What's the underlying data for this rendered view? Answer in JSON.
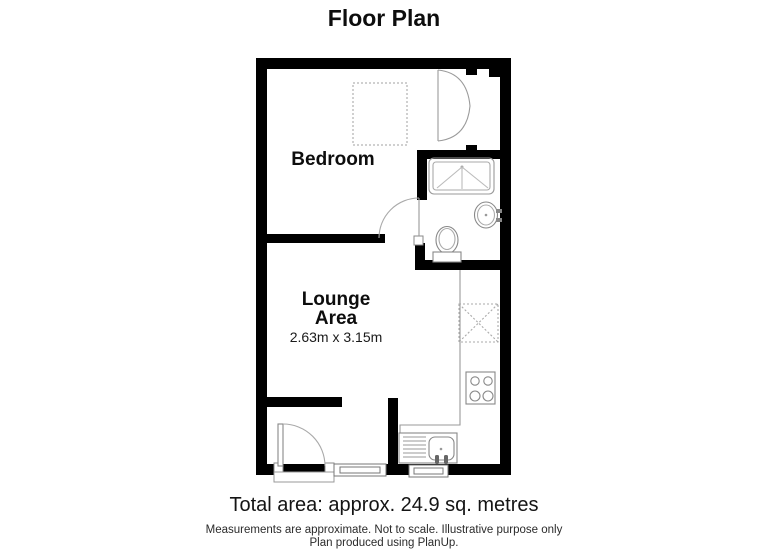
{
  "page": {
    "title": "Floor Plan",
    "background": "#ffffff"
  },
  "plan": {
    "rooms": [
      {
        "name": "bedroom",
        "label": "Bedroom"
      },
      {
        "name": "lounge-area",
        "label_line1": "Lounge",
        "label_line2": "Area",
        "dimensions": "2.63m x 3.15m"
      }
    ],
    "fixtures": [
      "bed-icon",
      "wardrobe-double-door-icon",
      "shower-icon",
      "basin-icon",
      "toilet-icon",
      "bathroom-door-icon",
      "kitchen-counter-line",
      "wall-cabinet-icon",
      "hob-icon",
      "kitchen-sink-icon",
      "entry-door-icon",
      "window-icon",
      "threshold-icon"
    ],
    "colors": {
      "wall": "#000000",
      "fixture_dark": "#888888",
      "fixture_light": "#aaaaaa",
      "dotted_outline": "#c0c0c0",
      "background": "#ffffff"
    }
  },
  "footer": {
    "total_area": "Total area: approx. 24.9 sq. metres",
    "disclaimer_line1": "Measurements are approximate. Not to scale. Illustrative purpose only",
    "disclaimer_line2": "Plan produced using PlanUp."
  }
}
